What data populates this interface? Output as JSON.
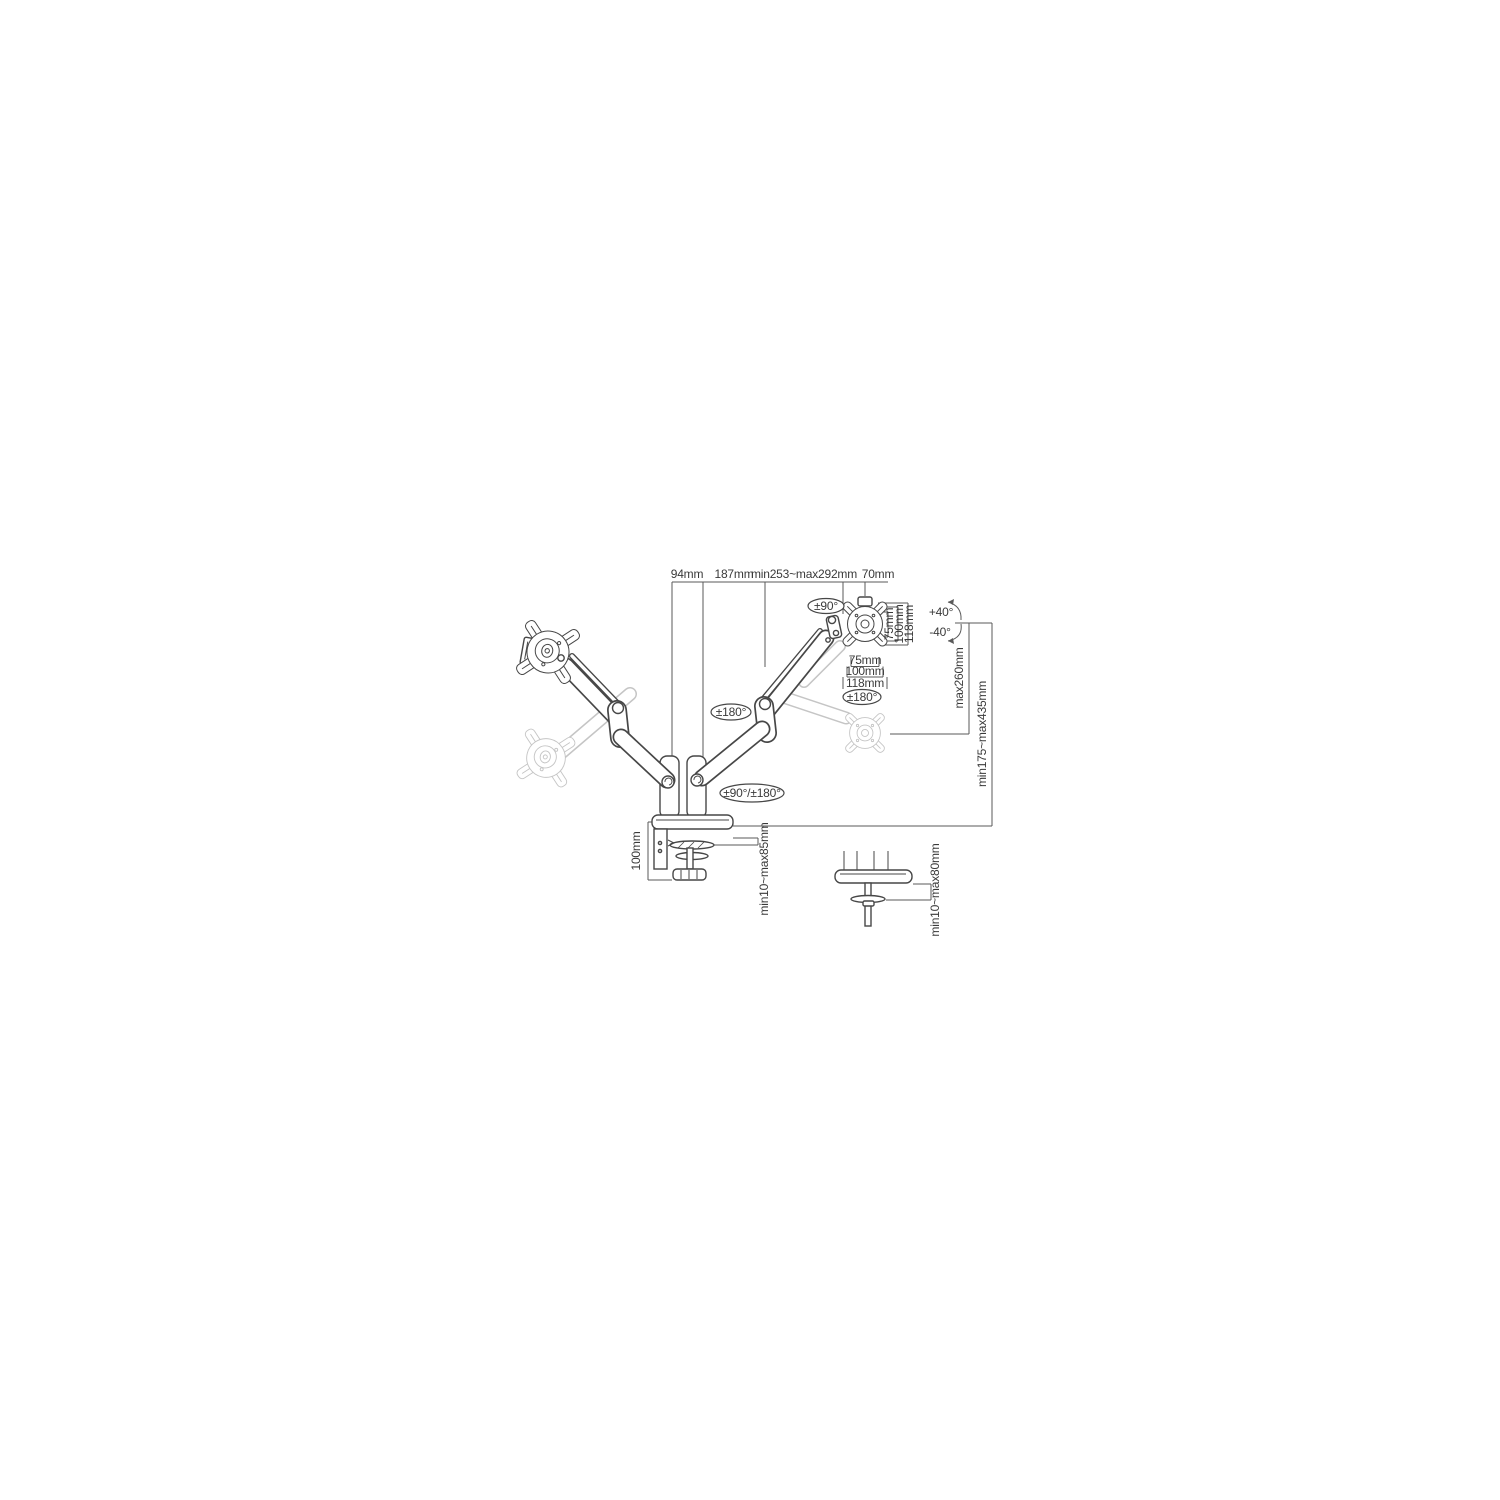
{
  "meta": {
    "description": "Technical dimension diagram of a dual-monitor gas-spring desk mount arm with clamp and grommet base"
  },
  "labels": {
    "top": {
      "d94": "94mm",
      "d187": "187mm",
      "d253": "min253~max292mm",
      "d70": "70mm"
    },
    "vesa_side": {
      "v75": "75mm",
      "v100": "100mm",
      "v118": "118mm"
    },
    "vesa_bottom": {
      "h75": "75mm",
      "h100": "100mm",
      "h118": "118mm"
    },
    "rotation": {
      "swivel": "±90°",
      "tilt_up": "+40°",
      "tilt_down": "-40°",
      "elbow": "±180°",
      "monitor": "±180°",
      "base": "±90°/±180°"
    },
    "height": {
      "lift": "max260mm",
      "range": "min175~max435mm"
    },
    "clamp": {
      "height": "100mm",
      "grip": "min10~max85mm"
    },
    "grommet": {
      "grip": "min10~max80mm"
    }
  },
  "colors": {
    "line": "#474747",
    "ghost": "#c5c5c5",
    "dimension": "#5a5a5a",
    "text": "#3a3a3a",
    "background": "#ffffff"
  }
}
